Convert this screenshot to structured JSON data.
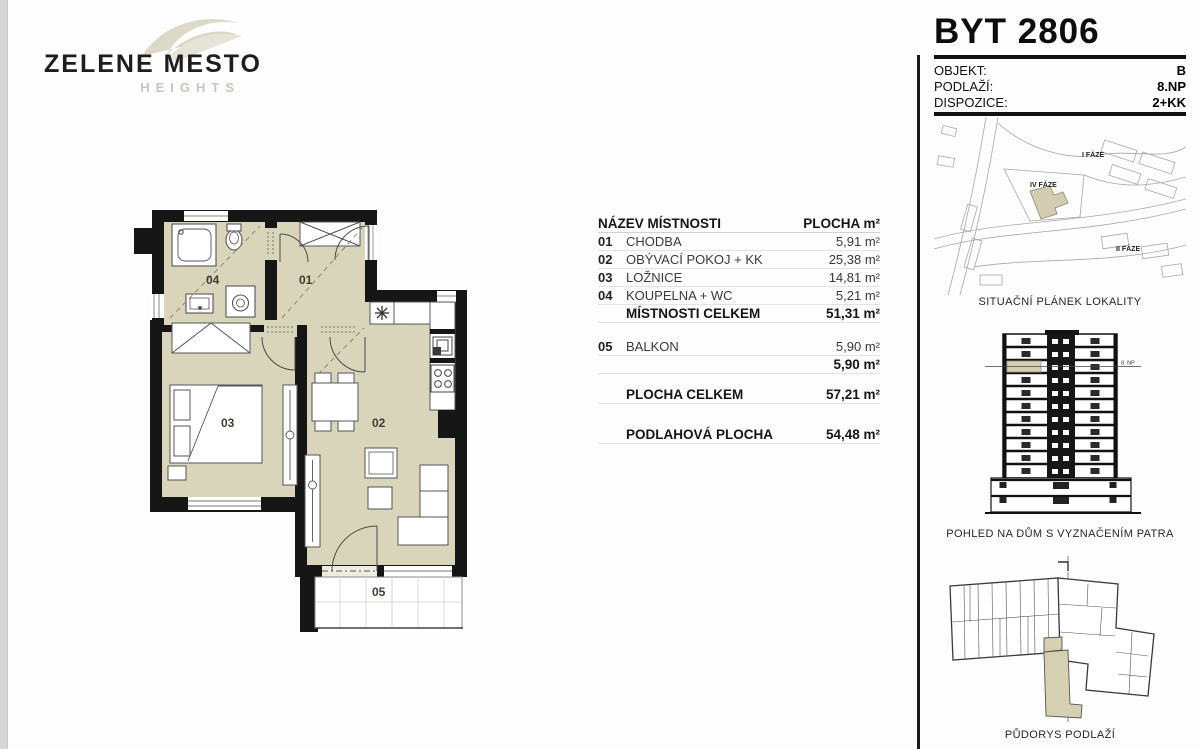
{
  "logo": {
    "name": "ZELENE MESTO",
    "sub": "HEIGHTS"
  },
  "floorplan": {
    "labels": {
      "hall": "01",
      "living": "02",
      "bedroom": "03",
      "bath": "04",
      "balcony": "05"
    }
  },
  "table": {
    "header": {
      "name": "NÁZEV MÍSTNOSTI",
      "area": "PLOCHA m²"
    },
    "rows": [
      {
        "num": "01",
        "name": "CHODBA",
        "area": "5,91 m²"
      },
      {
        "num": "02",
        "name": "OBÝVACÍ POKOJ + KK",
        "area": "25,38 m²"
      },
      {
        "num": "03",
        "name": "LOŽNICE",
        "area": "14,81 m²"
      },
      {
        "num": "04",
        "name": "KOUPELNA + WC",
        "area": "5,21 m²"
      },
      {
        "num": "",
        "name": "MÍSTNOSTI CELKEM",
        "area": "51,31 m²"
      },
      {
        "num": "05",
        "name": "BALKON",
        "area": "5,90 m²"
      },
      {
        "num": "",
        "name": "",
        "area": "5,90 m²"
      },
      {
        "num": "",
        "name": "PLOCHA CELKEM",
        "area": "57,21 m²"
      },
      {
        "num": "",
        "name": "PODLAHOVÁ PLOCHA",
        "area": "54,48 m²"
      }
    ]
  },
  "panel": {
    "title": "BYT 2806",
    "info": [
      {
        "label": "OBJEKT:",
        "value": "B"
      },
      {
        "label": "PODLAŽÍ:",
        "value": "8.NP"
      },
      {
        "label": "DISPOZICE:",
        "value": "2+KK"
      }
    ],
    "site_plan": {
      "phase1": "I FÁZE",
      "phase4": "IV FÁZE",
      "phase2": "II FÁZE",
      "caption": "SITUAČNÍ PLÁNEK LOKALITY"
    },
    "elevation": {
      "floor_label": "8. NP",
      "caption": "POHLED NA DŮM S VYZNAČENÍM PATRA"
    },
    "overview": {
      "caption": "PŮDORYS PODLAŽÍ"
    }
  },
  "colors": {
    "room_fill": "#d9d5ba",
    "wall": "#161616",
    "highlight": "#d5d0b2"
  }
}
